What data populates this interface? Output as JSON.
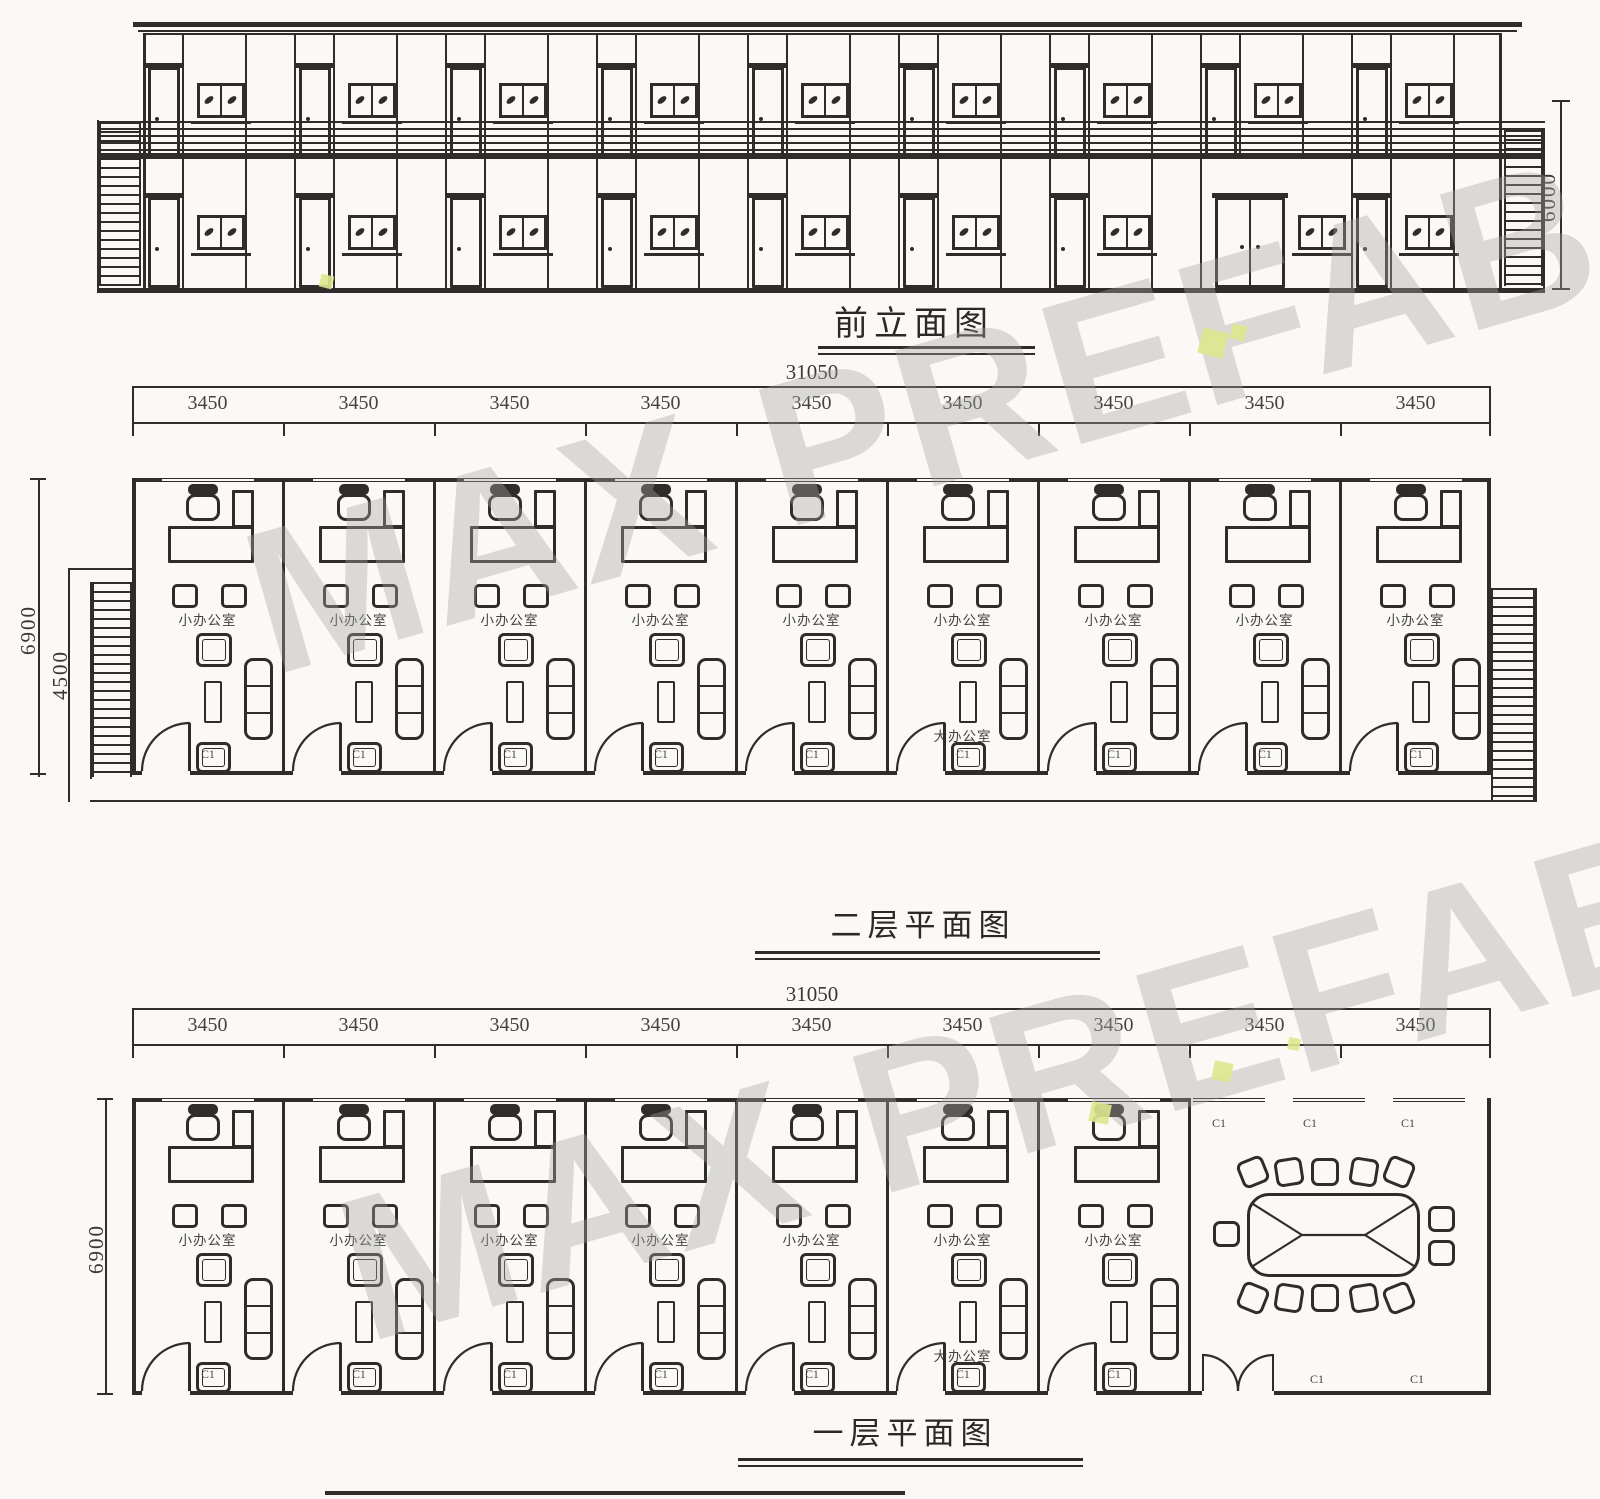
{
  "colors": {
    "ink": "#2f2d2b",
    "paper": "#faf9f6",
    "watermark": "#a6a6a0",
    "lime": "#dbe88f"
  },
  "watermark": {
    "text": "MAX PREFAB"
  },
  "elevation": {
    "title": "前立面图",
    "height_dim": "6000"
  },
  "floor2_plan": {
    "title": "二层平面图",
    "total_dim": "31050",
    "depth_dim": "6900",
    "inner_depth_dim": "4500",
    "bay_dims": [
      "3450",
      "3450",
      "3450",
      "3450",
      "3450",
      "3450",
      "3450",
      "3450",
      "3450"
    ],
    "offices": [
      {
        "name": "小办公室",
        "window": "C1"
      },
      {
        "name": "小办公室",
        "window": "C1"
      },
      {
        "name": "小办公室",
        "window": "C1"
      },
      {
        "name": "小办公室",
        "window": "C1"
      },
      {
        "name": "小办公室",
        "window": "C1"
      },
      {
        "name": "小办公室",
        "secondary_name": "大办公室",
        "window": "C1"
      },
      {
        "name": "小办公室",
        "window": "C1"
      },
      {
        "name": "小办公室",
        "window": "C1"
      },
      {
        "name": "小办公室",
        "window": "C1"
      }
    ]
  },
  "floor1_plan": {
    "title": "一层平面图",
    "total_dim": "31050",
    "depth_dim": "6900",
    "bay_dims": [
      "3450",
      "3450",
      "3450",
      "3450",
      "3450",
      "3450",
      "3450",
      "3450",
      "3450"
    ],
    "offices": [
      {
        "name": "小办公室",
        "window": "C1"
      },
      {
        "name": "小办公室",
        "window": "C1"
      },
      {
        "name": "小办公室",
        "window": "C1"
      },
      {
        "name": "小办公室",
        "window": "C1"
      },
      {
        "name": "小办公室",
        "window": "C1"
      },
      {
        "name": "小办公室",
        "secondary_name": "大办公室",
        "window": "C1"
      },
      {
        "name": "小办公室",
        "window": "C1"
      }
    ],
    "conference_room": {
      "window_labels_top": [
        "C1",
        "C1",
        "C1"
      ],
      "window_labels_bottom": [
        "C1",
        "C1"
      ]
    }
  }
}
